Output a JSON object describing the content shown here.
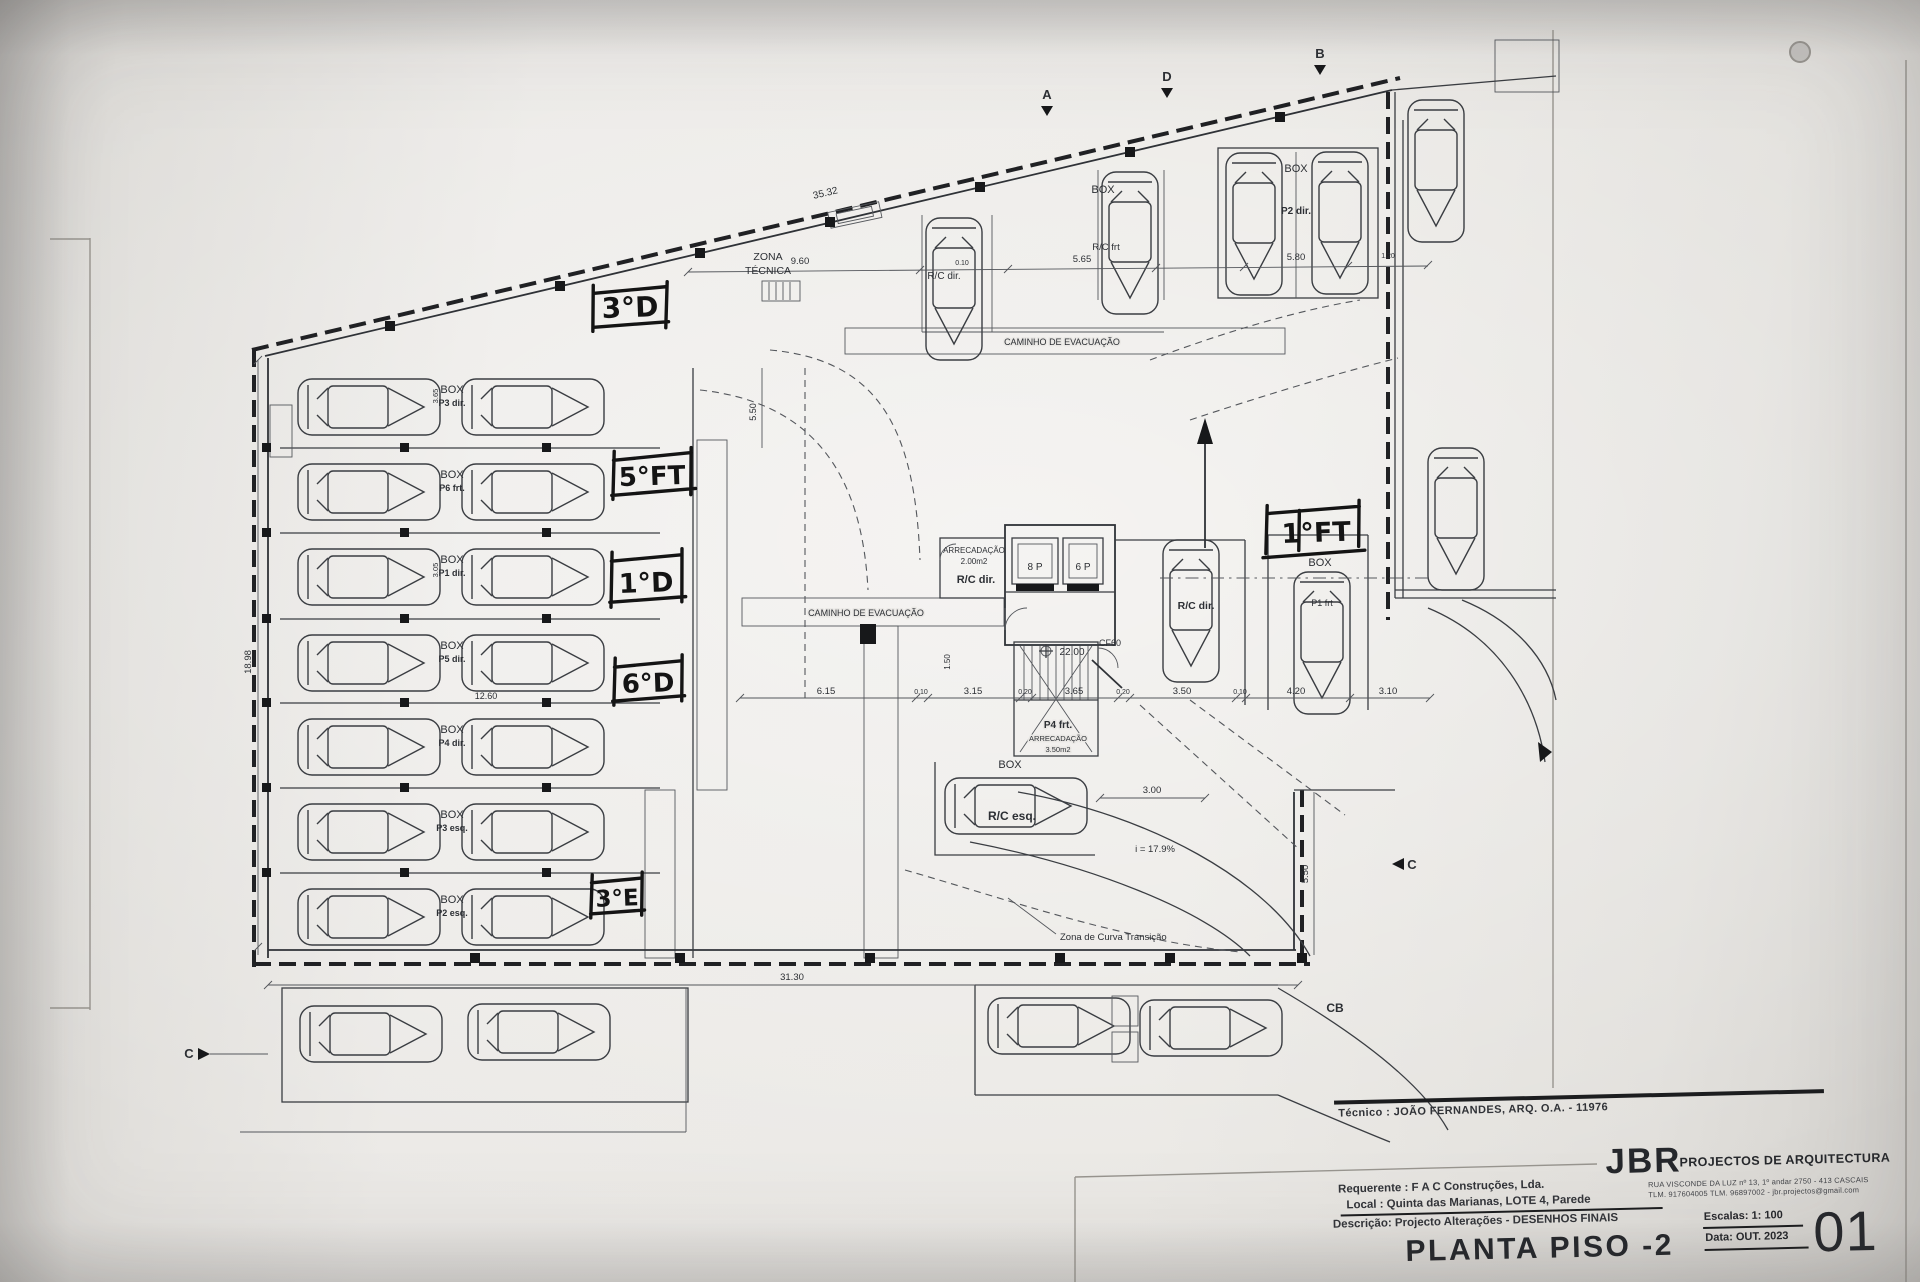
{
  "sheet": {
    "tecnico_line": "Técnico : JOÃO FERNANDES, ARQ.   O.A. - 11976",
    "firm_name": "JBR",
    "firm_tagline": "PROJECTOS DE ARQUITECTURA",
    "firm_address": "RUA VISCONDE DA LUZ nº 13, 1º andar  2750 - 413 CASCAIS",
    "firm_contacts": "TLM. 917604005  TLM. 96897002 - jbr.projectos@gmail.com",
    "requerente_label": "Requerente :",
    "requerente_value": "F A C  Construções, Lda.",
    "local_label": "Local :",
    "local_value": "Quinta das Marianas, LOTE 4, Parede",
    "descricao_label": "Descrição:",
    "descricao_value": "Projecto Alterações - DESENHOS FINAIS",
    "drawing_title": "PLANTA PISO -2",
    "scale_label": "Escalas:",
    "scale_value": "1: 100",
    "date_label": "Data:",
    "date_value": "OUT. 2023",
    "sheet_number": "01"
  },
  "handwritten": {
    "t3d": "3°D",
    "t5ft": "5°FT",
    "t1d": "1°D",
    "t6d": "6°D",
    "t3e": "3°E",
    "t1ft": "1°FT"
  },
  "plan": {
    "zona_tecnica_line1": "ZONA",
    "zona_tecnica_line2": "TÉCNICA",
    "caminho": "CAMINHO DE EVACUAÇÃO",
    "box": "BOX",
    "arrecadacao": "ARRECADAÇÃO",
    "arrec_area_small": "2.00m2",
    "arrec_area_large": "3.50m2",
    "rc_dir": "R/C dir.",
    "rc_esq": "R/C esq.",
    "rc_frt": "R/C frt",
    "p1_frt": "P1 frt",
    "p2_dir": "P2 dir.",
    "p4_frt": "P4 frt.",
    "lift_8p": "8 P",
    "lift_6p": "6 P",
    "cf60": "CF60",
    "level": "22.00",
    "slope": "i = 17.9%",
    "curva": "Zona de Curva Transição",
    "stalls": [
      {
        "p": "P3 dir."
      },
      {
        "p": "P6 frt."
      },
      {
        "p": "P1 dir."
      },
      {
        "p": "P5 dir."
      },
      {
        "p": "P4 dir."
      },
      {
        "p": "P3 esq."
      },
      {
        "p": "P2 esq."
      }
    ],
    "markers": {
      "a": "A",
      "b": "B",
      "c": "C",
      "d": "D",
      "cb": "CB"
    },
    "dims": {
      "top_total": "35.32",
      "top_a": "9.60",
      "top_b": "0.10",
      "top_c": "5.65",
      "top_d": "5.80",
      "top_e": "1.20",
      "left_total": "18.98",
      "row_width": "12.60",
      "ramp_width": "5.50",
      "mid_a": "6.15",
      "mid_b": "0.10",
      "mid_c": "3.15",
      "mid_d": "0.20",
      "mid_e": "3.65",
      "mid_f": "0.20",
      "mid_g": "3.50",
      "mid_h": "0.10",
      "mid_i": "4.20",
      "mid_j": "3.10",
      "corridor": "1.50",
      "right_a": "3.00",
      "right_b": "5.50",
      "bottom_total": "31.30",
      "stall_a": "3.65",
      "stall_b": "3.05"
    }
  }
}
